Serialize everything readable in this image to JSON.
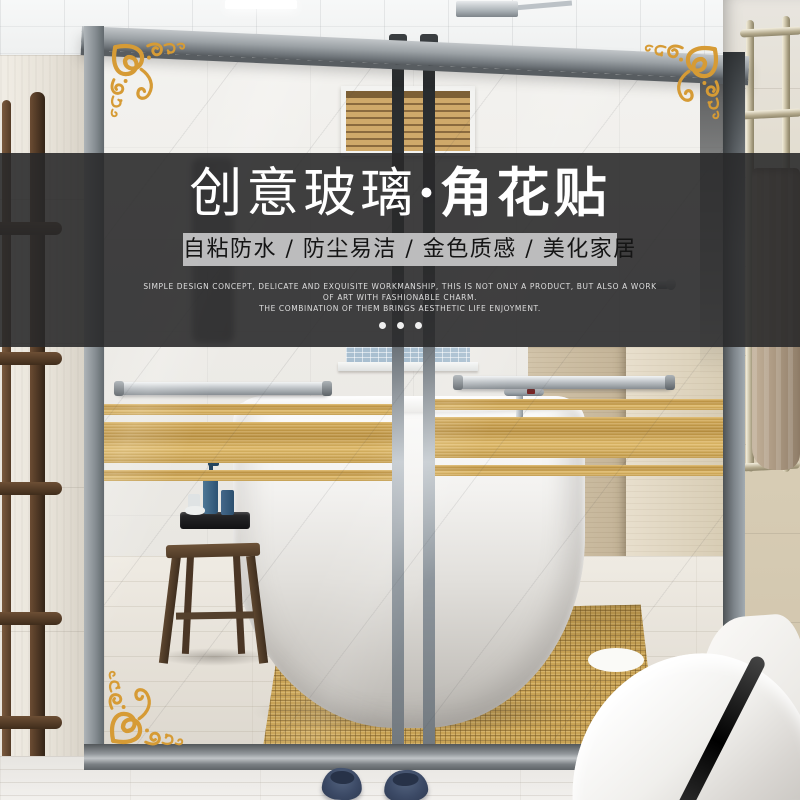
{
  "banner": {
    "title": {
      "regular": "创意玻璃",
      "separator": "·",
      "bold": "角花贴"
    },
    "subtitle": "自粘防水 / 防尘易洁 / 金色质感 / 美化家居",
    "description_lines": [
      "SIMPLE DESIGN CONCEPT, DELICATE AND EXQUISITE WORKMANSHIP, THIS IS NOT ONLY A PRODUCT, BUT ALSO A WORK",
      "OF ART WITH FASHIONABLE CHARM.",
      "THE COMBINATION OF THEM BRINGS AESTHETIC LIFE ENJOYMENT."
    ],
    "dots_count": 3,
    "colors": {
      "banner_bg": "rgba(40,40,42,0.89)",
      "title_text": "#ffffff",
      "subtitle_bg": "#c6c6c7",
      "subtitle_text": "#151515",
      "description_text": "#dedede",
      "dot": "#efefef"
    }
  },
  "scene": {
    "colors": {
      "ornament_gold": "#d69b35",
      "stripe_gold": "#c89a45",
      "frame_gray": "#8a9095",
      "mat_tan": "#c9a355",
      "towel_tan": "#a8957e",
      "slipper_navy": "#3c4a66",
      "wood_dark": "#53402c",
      "bottle_blue": "#3a6284",
      "blinds_wood": "#c5a468"
    }
  }
}
